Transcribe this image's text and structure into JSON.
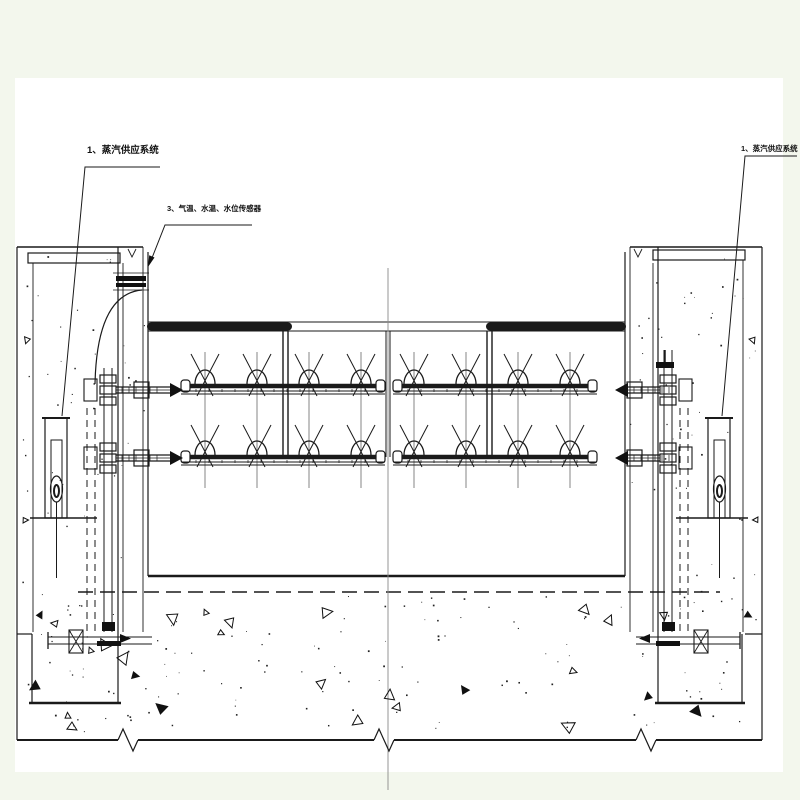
{
  "annotations": {
    "left_steam": {
      "text": "1、蒸汽供应系统"
    },
    "sensors": {
      "text": "3、气温、水温、水位传感器"
    },
    "right_steam": {
      "text": "1、蒸汽供应系统"
    }
  },
  "colors": {
    "canvas_tint": "#f3f7ed",
    "paper": "#ffffff",
    "ink": "#1a1a1a",
    "thin_line": "#666666",
    "centerline": "#8a8a8a"
  }
}
